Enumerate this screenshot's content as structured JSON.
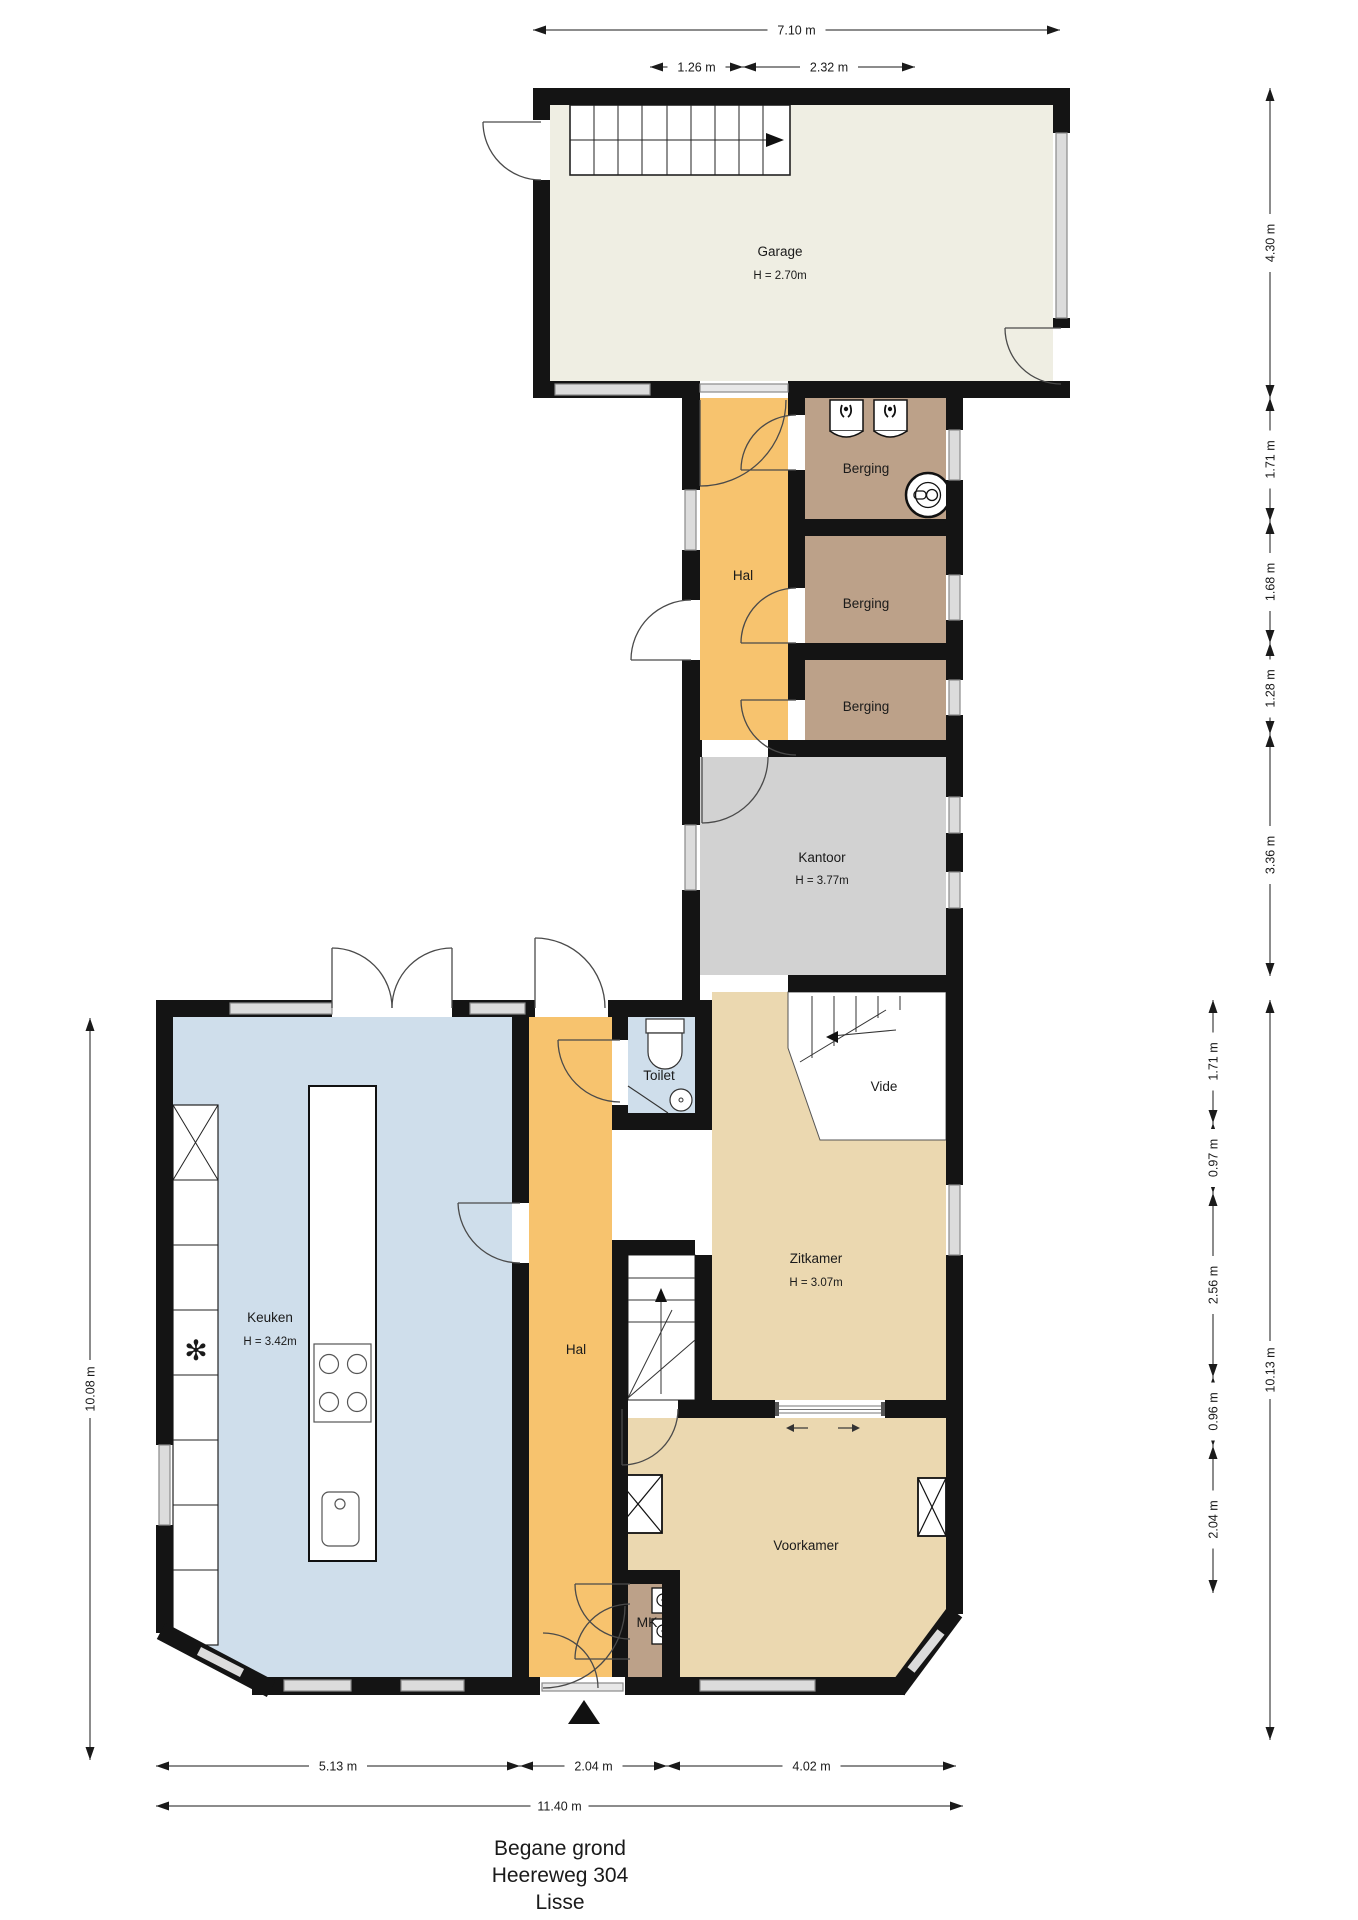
{
  "title": {
    "lines": [
      "Begane grond",
      "Heereweg 304",
      "Lisse"
    ]
  },
  "rooms": {
    "garage": {
      "name": "Garage",
      "height": "H = 2.70m"
    },
    "hal_top": {
      "name": "Hal"
    },
    "berging1": {
      "name": "Berging"
    },
    "berging2": {
      "name": "Berging"
    },
    "berging3": {
      "name": "Berging"
    },
    "kantoor": {
      "name": "Kantoor",
      "height": "H = 3.77m"
    },
    "toilet": {
      "name": "Toilet"
    },
    "vide": {
      "name": "Vide"
    },
    "zitkamer": {
      "name": "Zitkamer",
      "height": "H = 3.07m"
    },
    "keuken": {
      "name": "Keuken",
      "height": "H = 3.42m"
    },
    "hal_lower": {
      "name": "Hal"
    },
    "voorkamer": {
      "name": "Voorkamer"
    },
    "meterkast": {
      "name": "MK"
    }
  },
  "dimensions": {
    "top": [
      "7.10 m",
      "1.26 m",
      "2.32 m"
    ],
    "right_upper": [
      "4.30 m",
      "1.71 m",
      "1.68 m",
      "1.28 m",
      "3.36 m"
    ],
    "right_lower_inner": [
      "1.71 m",
      "0.97 m",
      "2.56 m",
      "0.96 m",
      "2.04 m"
    ],
    "right_lower_outer": [
      "10.13 m"
    ],
    "left": [
      "10.08 m"
    ],
    "bottom": [
      "5.13 m",
      "2.04 m",
      "4.02 m"
    ],
    "bottom_total": [
      "11.40 m"
    ]
  },
  "colors": {
    "wall": "#141414",
    "garage": "#efeee3",
    "hal": "#f7c36e",
    "berging": "#bca189",
    "kantoor": "#d2d2d2",
    "zitkamer": "#ebd8b0",
    "voorkamer": "#ebd8b0",
    "keuken": "#cfdeeb",
    "toilet": "#cfdeeb",
    "meterkast": "#bca189",
    "window": "#dcdcdc"
  },
  "icons": [
    "staircase-icon",
    "washing-machine-icon",
    "boiler-icon",
    "toilet-icon",
    "sink-icon",
    "stove-icon",
    "freezer-snowflake-icon",
    "closet-x-icon",
    "electric-meter-icon",
    "entrance-arrow-icon",
    "sliding-door-icon"
  ]
}
